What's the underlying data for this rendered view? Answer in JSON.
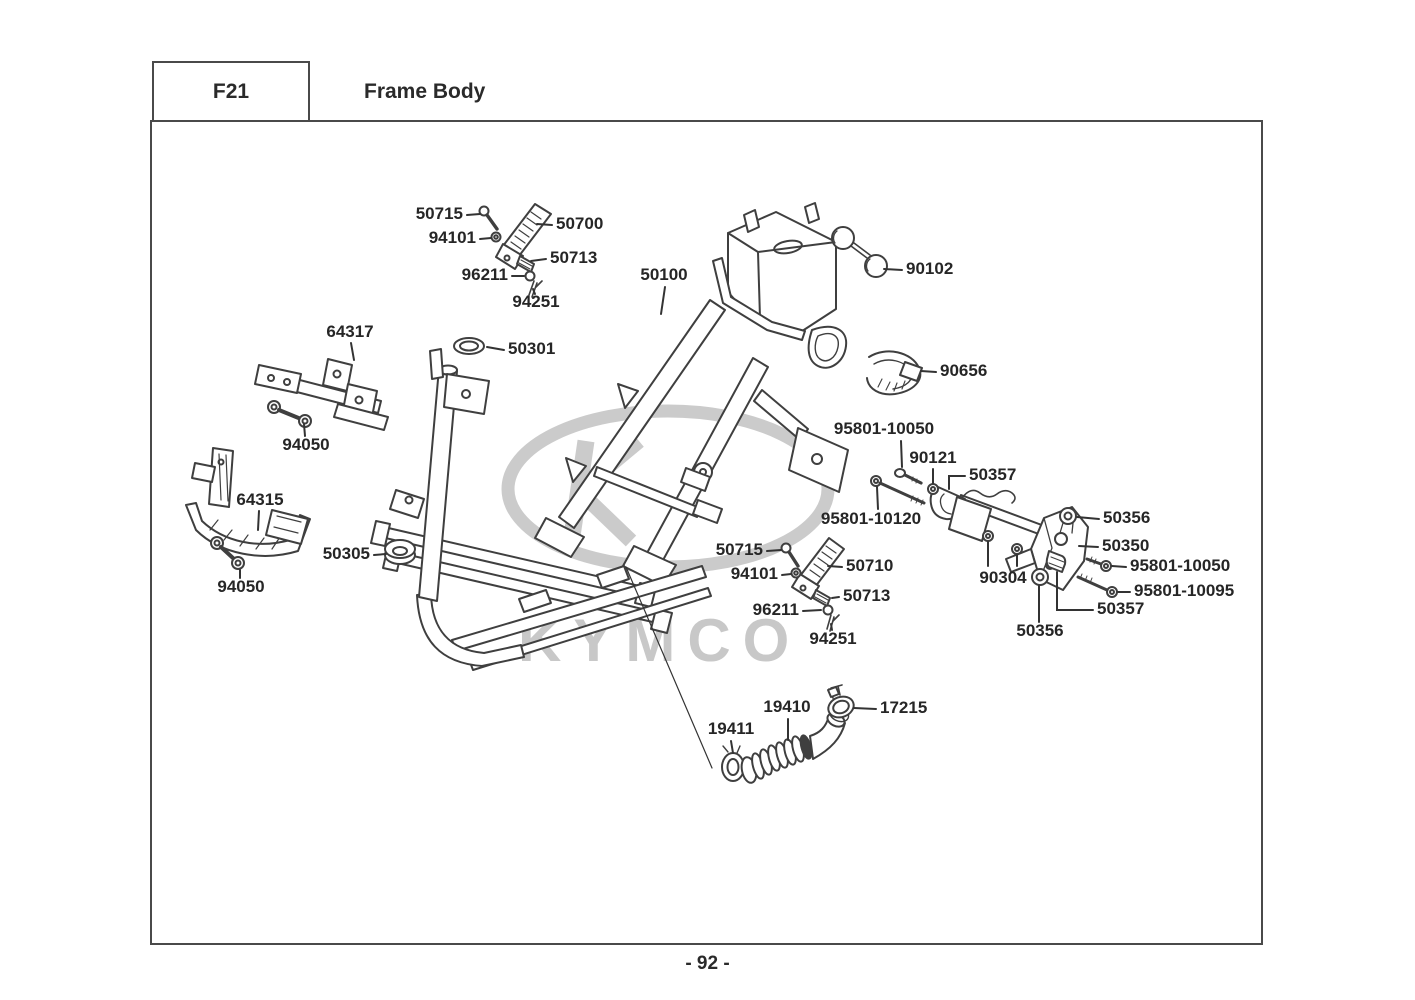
{
  "header": {
    "code": "F21",
    "title": "Frame Body"
  },
  "footer": {
    "page_number": "- 92 -"
  },
  "watermark": {
    "brand": "KYMCO",
    "color": "#c8c8c8"
  },
  "diagram": {
    "line_color": "#3f3f3f",
    "leader_color": "#333333",
    "labels": [
      {
        "id": "50715-a",
        "text": "50715",
        "x": 463,
        "y": 215,
        "align": "right",
        "leaders": [
          [
            [
              467,
              215
            ],
            [
              480,
              214
            ]
          ]
        ]
      },
      {
        "id": "94101-a",
        "text": "94101",
        "x": 476,
        "y": 239,
        "align": "right",
        "leaders": [
          [
            [
              480,
              239
            ],
            [
              491,
              238
            ]
          ]
        ]
      },
      {
        "id": "50700",
        "text": "50700",
        "x": 556,
        "y": 225,
        "align": "left",
        "leaders": [
          [
            [
              552,
              225
            ],
            [
              537,
              224
            ]
          ]
        ]
      },
      {
        "id": "50713-a",
        "text": "50713",
        "x": 550,
        "y": 259,
        "align": "left",
        "leaders": [
          [
            [
              546,
              259
            ],
            [
              531,
              261
            ]
          ]
        ]
      },
      {
        "id": "96211-a",
        "text": "96211",
        "x": 508,
        "y": 276,
        "align": "right",
        "leaders": [
          [
            [
              512,
              276
            ],
            [
              524,
              276
            ]
          ]
        ]
      },
      {
        "id": "94251-a",
        "text": "94251",
        "x": 536,
        "y": 303,
        "align": "center",
        "leaders": [
          [
            [
              535,
              294
            ],
            [
              533,
              289
            ]
          ]
        ]
      },
      {
        "id": "50100",
        "text": "50100",
        "x": 664,
        "y": 276,
        "align": "center",
        "leaders": [
          [
            [
              665,
              287
            ],
            [
              661,
              314
            ]
          ]
        ]
      },
      {
        "id": "90102",
        "text": "90102",
        "x": 906,
        "y": 270,
        "align": "left",
        "leaders": [
          [
            [
              902,
              270
            ],
            [
              884,
              269
            ]
          ]
        ]
      },
      {
        "id": "64317",
        "text": "64317",
        "x": 350,
        "y": 333,
        "align": "center",
        "leaders": [
          [
            [
              351,
              343
            ],
            [
              354,
              360
            ]
          ]
        ]
      },
      {
        "id": "50301",
        "text": "50301",
        "x": 508,
        "y": 350,
        "align": "left",
        "leaders": [
          [
            [
              504,
              350
            ],
            [
              487,
              347
            ]
          ]
        ]
      },
      {
        "id": "90656",
        "text": "90656",
        "x": 940,
        "y": 372,
        "align": "left",
        "leaders": [
          [
            [
              936,
              372
            ],
            [
              921,
              371
            ]
          ]
        ]
      },
      {
        "id": "94050-a",
        "text": "94050",
        "x": 306,
        "y": 446,
        "align": "center",
        "leaders": [
          [
            [
              305,
              436
            ],
            [
              304,
              424
            ]
          ]
        ]
      },
      {
        "id": "64315",
        "text": "64315",
        "x": 260,
        "y": 501,
        "align": "center",
        "leaders": [
          [
            [
              259,
              511
            ],
            [
              258,
              530
            ]
          ]
        ]
      },
      {
        "id": "50305",
        "text": "50305",
        "x": 370,
        "y": 555,
        "align": "right",
        "leaders": [
          [
            [
              374,
              555
            ],
            [
              386,
              554
            ]
          ]
        ]
      },
      {
        "id": "94050-b",
        "text": "94050",
        "x": 241,
        "y": 588,
        "align": "center",
        "leaders": [
          [
            [
              240,
              578
            ],
            [
              240,
              570
            ]
          ]
        ]
      },
      {
        "id": "95801-10050-a",
        "text": "95801-10050",
        "x": 884,
        "y": 430,
        "align": "center",
        "leaders": [
          [
            [
              901,
              441
            ],
            [
              902,
              467
            ]
          ]
        ]
      },
      {
        "id": "90121",
        "text": "90121",
        "x": 933,
        "y": 459,
        "align": "center",
        "leaders": [
          [
            [
              933,
              469
            ],
            [
              933,
              483
            ]
          ]
        ]
      },
      {
        "id": "50357-a",
        "text": "50357",
        "x": 969,
        "y": 476,
        "align": "left",
        "leaders": [
          [
            [
              965,
              476
            ],
            [
              949,
              476
            ],
            [
              949,
              489
            ]
          ]
        ]
      },
      {
        "id": "95801-10120",
        "text": "95801-10120",
        "x": 871,
        "y": 520,
        "align": "center",
        "leaders": [
          [
            [
              878,
              509
            ],
            [
              877,
              487
            ]
          ]
        ]
      },
      {
        "id": "50356-a",
        "text": "50356",
        "x": 1103,
        "y": 519,
        "align": "left",
        "leaders": [
          [
            [
              1099,
              519
            ],
            [
              1077,
              517
            ]
          ]
        ]
      },
      {
        "id": "50350",
        "text": "50350",
        "x": 1102,
        "y": 547,
        "align": "left",
        "leaders": [
          [
            [
              1098,
              547
            ],
            [
              1079,
              546
            ]
          ]
        ]
      },
      {
        "id": "90304",
        "text": "90304",
        "x": 1003,
        "y": 579,
        "align": "center",
        "leaders": [
          [
            [
              988,
              542
            ],
            [
              988,
              566
            ]
          ],
          [
            [
              1017,
              555
            ],
            [
              1017,
              566
            ]
          ]
        ]
      },
      {
        "id": "95801-10050-b",
        "text": "95801-10050",
        "x": 1130,
        "y": 567,
        "align": "left",
        "leaders": [
          [
            [
              1126,
              567
            ],
            [
              1112,
              566
            ]
          ]
        ]
      },
      {
        "id": "95801-10095",
        "text": "95801-10095",
        "x": 1134,
        "y": 592,
        "align": "left",
        "leaders": [
          [
            [
              1130,
              592
            ],
            [
              1118,
              592
            ]
          ]
        ]
      },
      {
        "id": "50357-b",
        "text": "50357",
        "x": 1097,
        "y": 610,
        "align": "left",
        "leaders": [
          [
            [
              1093,
              610
            ],
            [
              1057,
              610
            ],
            [
              1057,
              572
            ]
          ]
        ]
      },
      {
        "id": "50356-b",
        "text": "50356",
        "x": 1040,
        "y": 632,
        "align": "center",
        "leaders": [
          [
            [
              1039,
              622
            ],
            [
              1039,
              586
            ]
          ]
        ]
      },
      {
        "id": "50715-b",
        "text": "50715",
        "x": 763,
        "y": 551,
        "align": "right",
        "leaders": [
          [
            [
              767,
              551
            ],
            [
              781,
              550
            ]
          ]
        ]
      },
      {
        "id": "94101-b",
        "text": "94101",
        "x": 778,
        "y": 575,
        "align": "right",
        "leaders": [
          [
            [
              782,
              575
            ],
            [
              791,
              574
            ]
          ]
        ]
      },
      {
        "id": "50710",
        "text": "50710",
        "x": 846,
        "y": 567,
        "align": "left",
        "leaders": [
          [
            [
              842,
              567
            ],
            [
              828,
              566
            ]
          ]
        ]
      },
      {
        "id": "50713-b",
        "text": "50713",
        "x": 843,
        "y": 597,
        "align": "left",
        "leaders": [
          [
            [
              839,
              597
            ],
            [
              832,
              598
            ]
          ]
        ]
      },
      {
        "id": "96211-b",
        "text": "96211",
        "x": 799,
        "y": 611,
        "align": "right",
        "leaders": [
          [
            [
              803,
              611
            ],
            [
              821,
              610
            ]
          ]
        ]
      },
      {
        "id": "94251-b",
        "text": "94251",
        "x": 833,
        "y": 640,
        "align": "center",
        "leaders": [
          [
            [
              832,
              630
            ],
            [
              831,
              624
            ]
          ]
        ]
      },
      {
        "id": "19410",
        "text": "19410",
        "x": 787,
        "y": 708,
        "align": "center",
        "leaders": [
          [
            [
              788,
              719
            ],
            [
              788,
              740
            ]
          ]
        ]
      },
      {
        "id": "17215",
        "text": "17215",
        "x": 880,
        "y": 709,
        "align": "left",
        "leaders": [
          [
            [
              876,
              709
            ],
            [
              854,
              708
            ]
          ]
        ]
      },
      {
        "id": "19411",
        "text": "19411",
        "x": 731,
        "y": 730,
        "align": "center",
        "leaders": [
          [
            [
              731,
              741
            ],
            [
              733,
              753
            ]
          ]
        ]
      }
    ],
    "extra_leaders": [
      [
        [
          626,
          567
        ],
        [
          712,
          768
        ]
      ]
    ]
  }
}
